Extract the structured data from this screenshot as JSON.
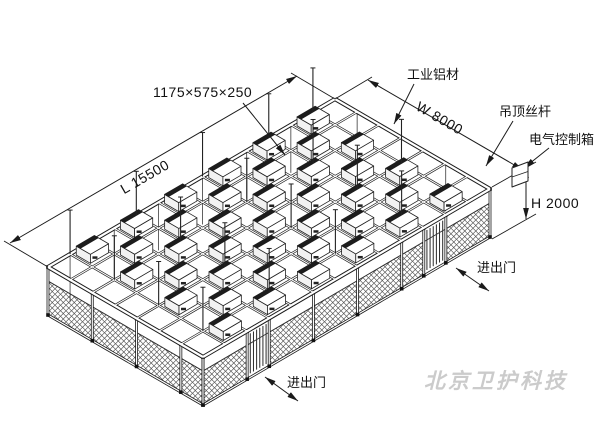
{
  "drawing": {
    "title": "modular cleanroom frame isometric drawing",
    "dimensions": {
      "module_size": "1175×575×250",
      "length": "L 15500",
      "width": "W 8000",
      "height": "H 2000"
    },
    "callouts": {
      "aluminum_profile": "工业铝材",
      "ceiling_rod": "吊顶丝杆",
      "electric_control_box": "电气控制箱",
      "door_right": "进出门",
      "door_front": "进出门"
    },
    "watermark": "北京卫护科技",
    "colors": {
      "line": "#1a1a1a",
      "mesh": "#4a4a4a",
      "watermark": "#cbcbcb",
      "background": "#ffffff"
    }
  }
}
